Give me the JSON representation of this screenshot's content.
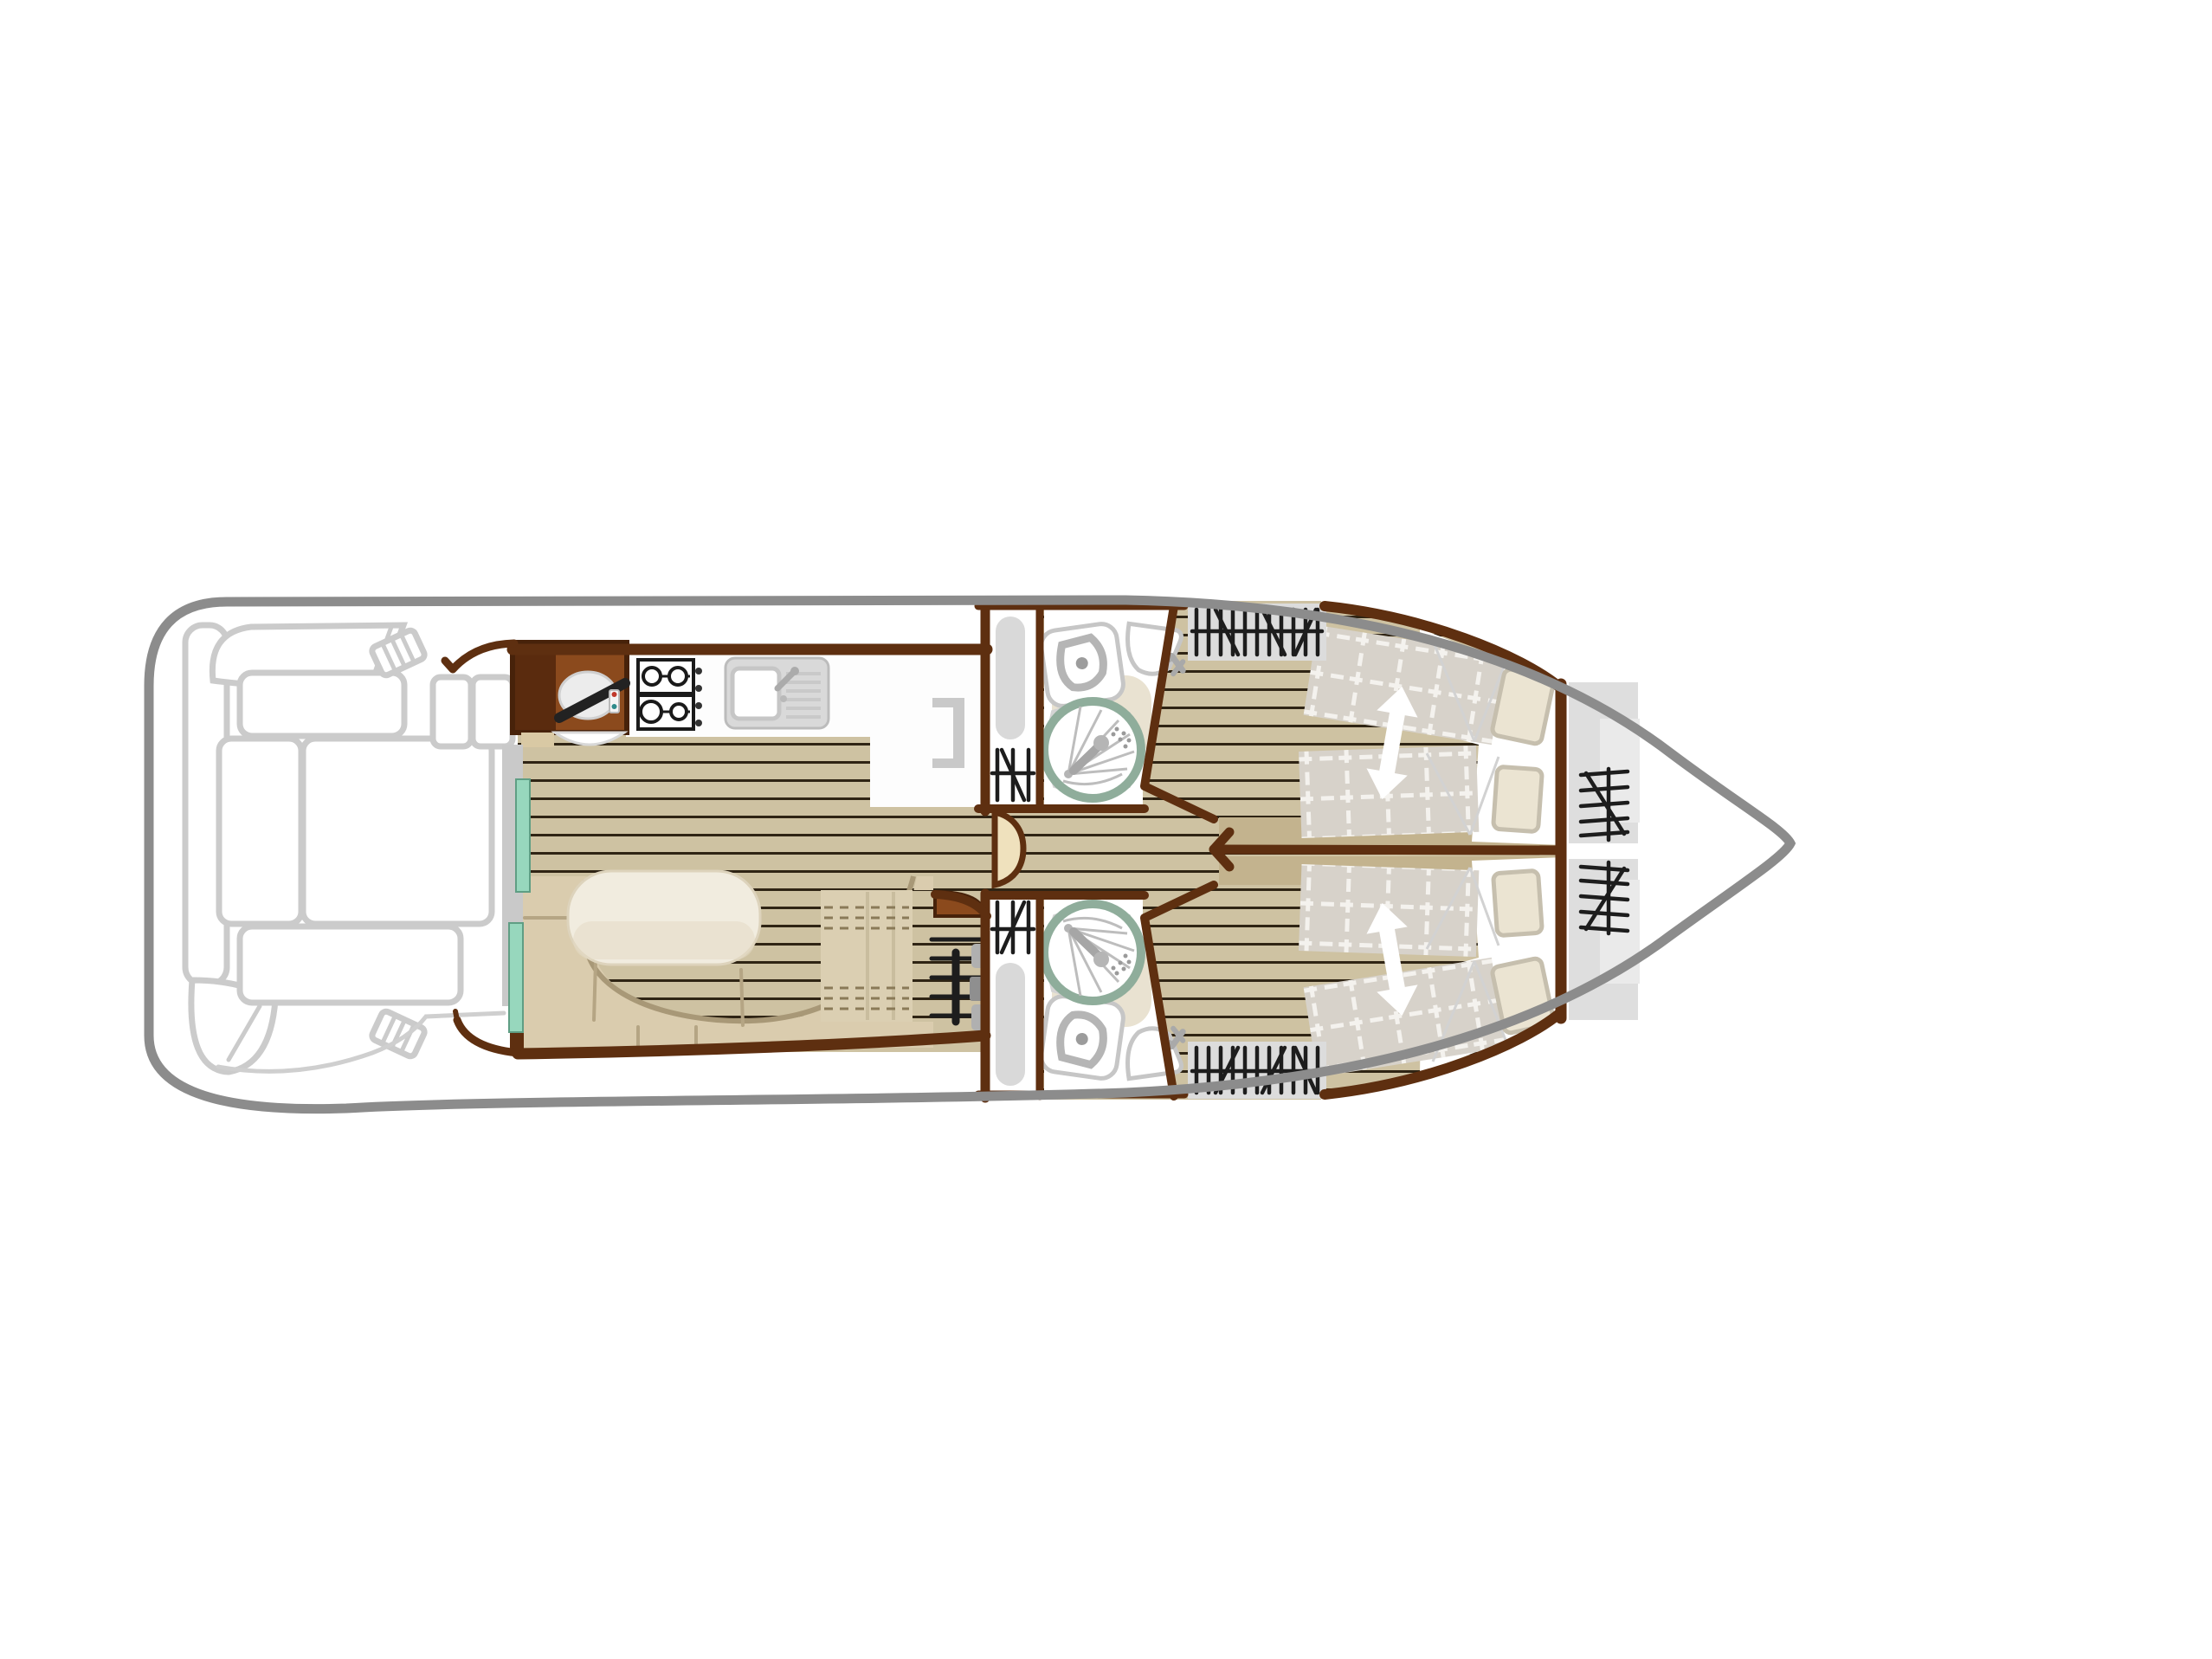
{
  "colors": {
    "hull": "#8c8c8c",
    "wall": "#5e2f10",
    "wallDark": "#47220a",
    "consoleDark": "#5a2b0e",
    "consolePanel": "#8b4a1d",
    "floor": "#cec2a2",
    "plank": "#2f2414",
    "darkTan": "#c3b38e",
    "counter": "#fdfdfd",
    "fixture": "#c6c6c6",
    "fixtureMid": "#b9b9b9",
    "showerRing": "#8fad9b",
    "teal": "#97d7bd",
    "tealEdge": "#5f9e84",
    "jamb": "#c9c9c9",
    "sofa": "#daccae",
    "sofaEdge": "#a89877",
    "sofaSeam": "#b5a584",
    "table": "#f1ecdf",
    "tableShade": "#e4dbc4",
    "drawer": "#dbcfb2",
    "drawerDash": "#8a7a58",
    "quilt": "#d7d2ca",
    "quiltLine": "#f4f2ee",
    "pillow": "#ebe4d2",
    "pillowEdge": "#c6bfae",
    "wardrobe": "#dcdcdc",
    "bowShelf": "#dedede",
    "bowShelfLight": "#eaeaea",
    "hanger": "#1d1d1d",
    "beige": "#e9e2d1",
    "doorLeaf": "#efe1bd",
    "deckFurn": "#cbcbcb",
    "tread": "#1d1d1d",
    "stepBeige": "#d9c9a4"
  },
  "labels": {
    "plan": "Boat deck floor plan",
    "hull": "Hull outline",
    "aft_deck": "Aft deck seating",
    "entry": "Sliding entry door",
    "galley": "Galley",
    "steering": "Steering console",
    "dinette": "Dinette with table",
    "floors": "Wood plank flooring",
    "corridor_door": "Corridor door",
    "bathroom_top": "Shower room",
    "bathroom_bottom": "Shower room",
    "cabin_top": "Double cabin",
    "cabin_bottom": "Double cabin",
    "bow_storage": "Bow storage shelves",
    "steps": "Companionway steps"
  },
  "icons": [
    "steering-wheel-icon",
    "stove-icon",
    "sink-icon",
    "fridge-icon",
    "toilet-icon",
    "washbasin-icon",
    "shower-icon",
    "hanger-rail-icon",
    "closet-hanger-icon",
    "steps-icon",
    "bed-arrow-icon",
    "sliding-door-icon"
  ]
}
